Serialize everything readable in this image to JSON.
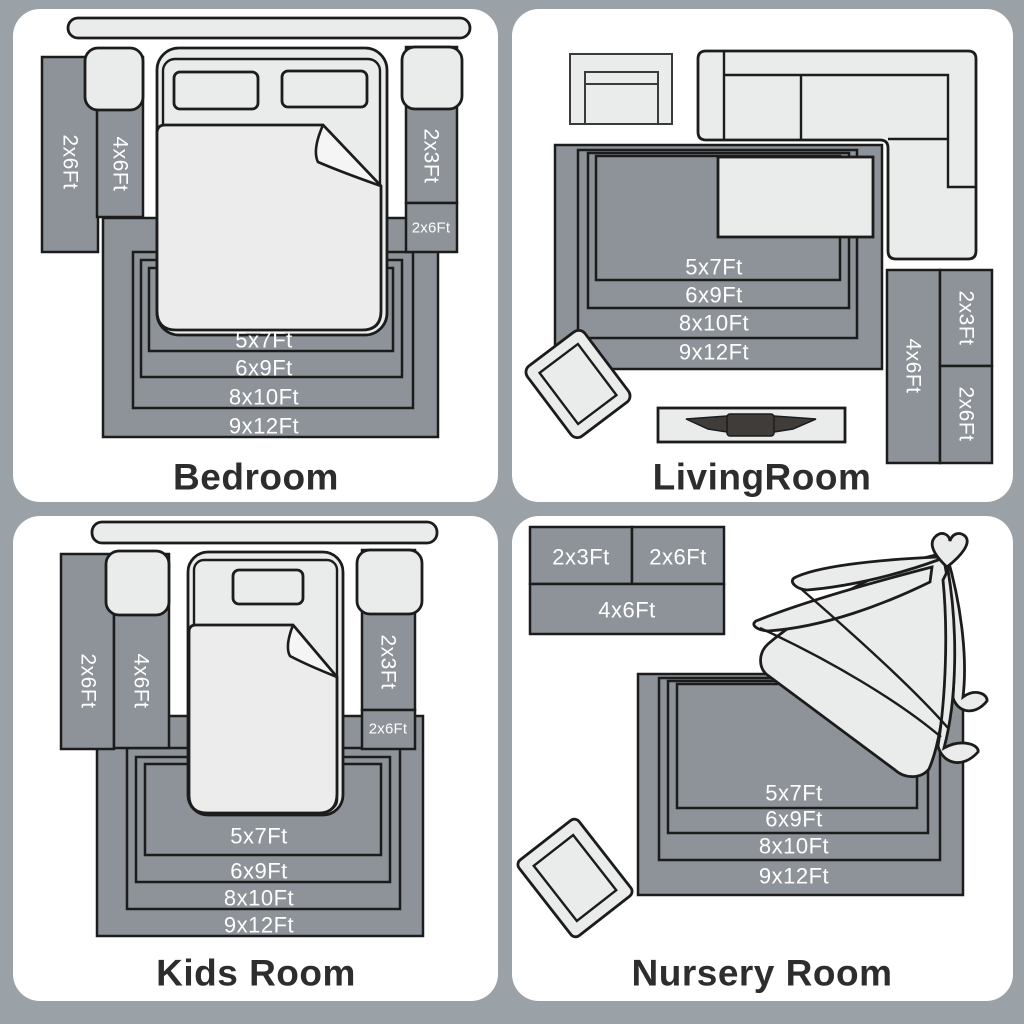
{
  "colors": {
    "background": "#9aa1a7",
    "card": "#ffffff",
    "rug": "#8d9399",
    "furniture": "#eaebeb",
    "outline": "#1c1c1c",
    "label": "#ffffff",
    "title": "#2d2d2d",
    "tv": "#3f3c39"
  },
  "bedroom": {
    "title": "Bedroom",
    "left_runner": "2x6Ft",
    "left_rug": "4x6Ft",
    "right_rug": "2x3Ft",
    "right_runner": "2x6Ft",
    "nested": [
      "5x7Ft",
      "6x9Ft",
      "8x10Ft",
      "9x12Ft"
    ]
  },
  "livingroom": {
    "title": "LivingRoom",
    "nested": [
      "5x7Ft",
      "6x9Ft",
      "8x10Ft",
      "9x12Ft"
    ],
    "side_rug_tall": "4x6Ft",
    "side_rug_top": "2x3Ft",
    "side_rug_bottom": "2x6Ft"
  },
  "kidsroom": {
    "title": "Kids Room",
    "left_runner": "2x6Ft",
    "left_rug": "4x6Ft",
    "right_rug": "2x3Ft",
    "right_runner": "2x6Ft",
    "nested": [
      "5x7Ft",
      "6x9Ft",
      "8x10Ft",
      "9x12Ft"
    ]
  },
  "nursery": {
    "title": "Nursery Room",
    "block_left": "2x3Ft",
    "block_right": "2x6Ft",
    "block_bottom": "4x6Ft",
    "nested": [
      "5x7Ft",
      "6x9Ft",
      "8x10Ft",
      "9x12Ft"
    ]
  }
}
